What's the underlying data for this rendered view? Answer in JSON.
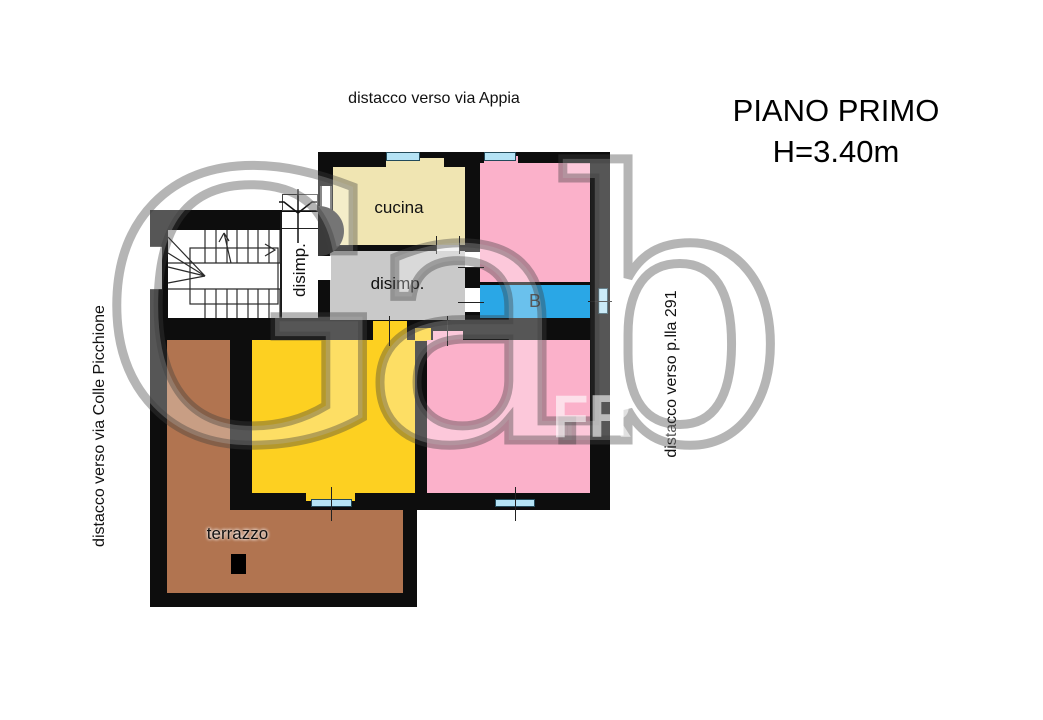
{
  "title": {
    "line1": "PIANO PRIMO",
    "line2": "H=3.40m"
  },
  "annotations": {
    "top": "distacco verso via Appia",
    "left": "distacco verso via Colle Picchione",
    "right": "distacco verso p.lla 291"
  },
  "rooms": {
    "cucina": {
      "label": "cucina",
      "color": "#f0e5b2"
    },
    "corridor": {
      "label": "disimp.",
      "color": "#ffffff"
    },
    "hall": {
      "label": "disimp.",
      "color": "#c9c9c9"
    },
    "bathroom": {
      "label": "B",
      "color": "#2aa7e6"
    },
    "bedroom_north": {
      "color": "#fbb1ca"
    },
    "bedroom_south": {
      "color": "#fbb1ca"
    },
    "room_yellow": {
      "color": "#fdd021"
    },
    "balcony": {
      "color": "#b17450"
    },
    "terrace": {
      "label": "terrazzo",
      "color": "#b17450"
    }
  },
  "plan": {
    "wall_color": "#0d0d0d",
    "window_color": "#b5e3f5",
    "stair_line_color": "#2a2a2a"
  },
  "watermark": {
    "main": "Gab",
    "secondary": "FR"
  }
}
